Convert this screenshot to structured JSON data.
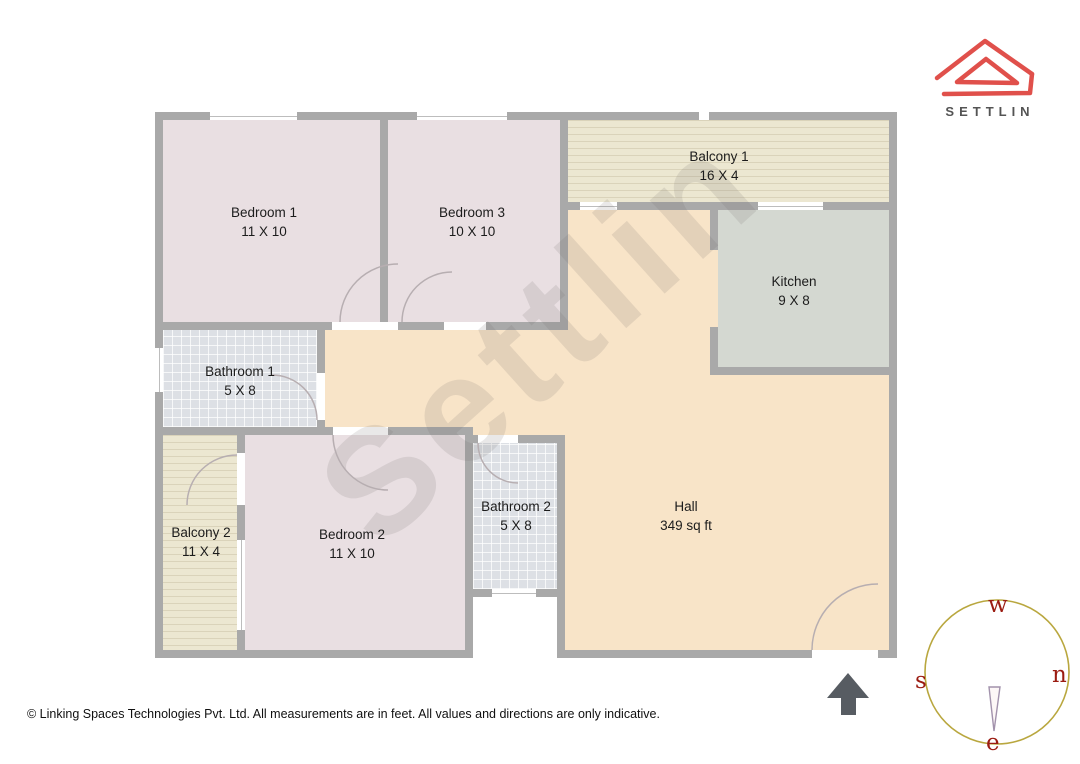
{
  "brand": {
    "name": "SETTLIN",
    "logo_color": "#e0504b",
    "wordmark_color": "#545454"
  },
  "watermark": "Settlin",
  "rooms": [
    {
      "id": "bedroom-1",
      "label": "Bedroom 1",
      "size": "11 X 10"
    },
    {
      "id": "bedroom-3",
      "label": "Bedroom 3",
      "size": "10 X 10"
    },
    {
      "id": "balcony-1",
      "label": "Balcony 1",
      "size": "16 X 4"
    },
    {
      "id": "kitchen",
      "label": "Kitchen",
      "size": "9 X 8"
    },
    {
      "id": "bathroom-1",
      "label": "Bathroom 1",
      "size": "5 X 8"
    },
    {
      "id": "balcony-2",
      "label": "Balcony 2",
      "size": "11 X 4"
    },
    {
      "id": "bedroom-2",
      "label": "Bedroom 2",
      "size": "11 X 10"
    },
    {
      "id": "bathroom-2",
      "label": "Bathroom 2",
      "size": "5 X 8"
    },
    {
      "id": "hall",
      "label": "Hall",
      "size": "349 sq ft"
    }
  ],
  "compass": {
    "top": "w",
    "right": "n",
    "left": "s",
    "bottom": "e",
    "circle_color": "#b9a73f",
    "letter_color": "#9b1c12"
  },
  "colors": {
    "wall": "#a9a9a9",
    "hall_floor": "#f8e4c8",
    "bedroom_floor": "#e9dfe2",
    "kitchen_floor": "#d4d8d1",
    "balcony_floor": "#ece7d1",
    "bathroom_floor": "#dde0e5",
    "entrance_arrow": "#575c62"
  },
  "footer": "© Linking Spaces Technologies Pvt. Ltd. All measurements are in feet. All values and directions are only indicative."
}
